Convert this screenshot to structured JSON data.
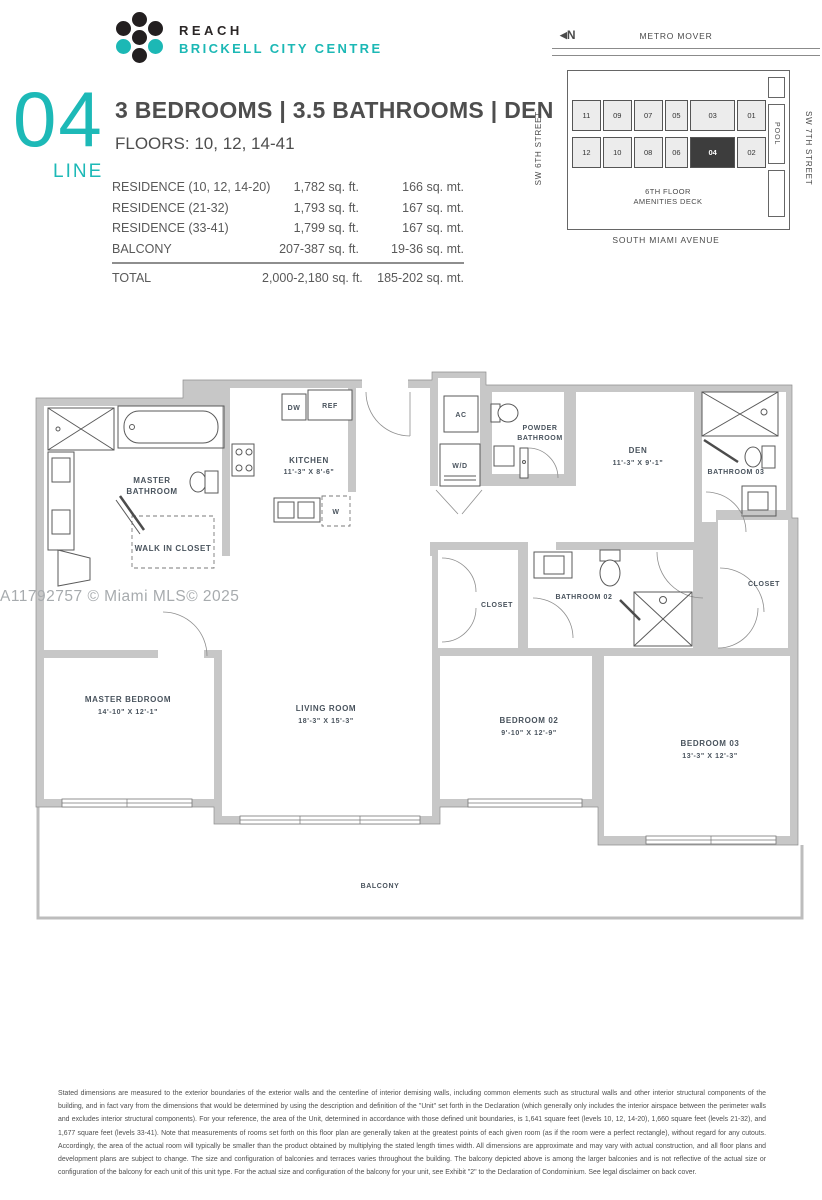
{
  "brand": {
    "line1": "REACH",
    "line2": "BRICKELL CITY CENTRE"
  },
  "unit": {
    "number": "04",
    "line_label": "LINE",
    "title": "3 BEDROOMS  |  3.5 BATHROOMS  |  DEN",
    "floors": "FLOORS: 10, 12, 14-41"
  },
  "area_table": {
    "rows": [
      {
        "label": "RESIDENCE (10, 12, 14-20)",
        "sqft": "1,782 sq. ft.",
        "sqmt": "166 sq. mt."
      },
      {
        "label": "RESIDENCE (21-32)",
        "sqft": "1,793 sq. ft.",
        "sqmt": "167 sq. mt."
      },
      {
        "label": "RESIDENCE (33-41)",
        "sqft": "1,799 sq. ft.",
        "sqmt": "167 sq. mt."
      },
      {
        "label": "BALCONY",
        "sqft": "207-387 sq. ft.",
        "sqmt": "19-36 sq. mt."
      }
    ],
    "total": {
      "label": "TOTAL",
      "sqft": "2,000-2,180 sq. ft.",
      "sqmt": "185-202 sq. mt."
    }
  },
  "key_plan": {
    "north": "N",
    "north_arrow": "◀",
    "metro_mover": "METRO MOVER",
    "street_left": "SW 6TH STREET",
    "street_right": "SW 7TH STREET",
    "avenue": "SOUTH MIAMI AVENUE",
    "pool": "POOL",
    "amenities_1": "6TH FLOOR",
    "amenities_2": "AMENITIES DECK",
    "top_row": [
      "11",
      "09",
      "07",
      "05",
      "03",
      "01"
    ],
    "bottom_row": [
      "12",
      "10",
      "08",
      "06",
      "04",
      "02"
    ],
    "highlighted_unit": "04"
  },
  "floor_plan": {
    "labels": {
      "master_bathroom_1": "MASTER",
      "master_bathroom_2": "BATHROOM",
      "walk_in_closet": "WALK IN CLOSET",
      "kitchen_1": "KITCHEN",
      "kitchen_2": "11'-3\" X 8'-6\"",
      "dw": "DW",
      "ref": "REF",
      "w": "W",
      "ac": "AC",
      "wd": "W/D",
      "powder_1": "POWDER",
      "powder_2": "BATHROOM",
      "den_1": "DEN",
      "den_2": "11'-3\" X 9'-1\"",
      "bathroom_03": "BATHROOM 03",
      "closet_right": "CLOSET",
      "closet_middle": "CLOSET",
      "bathroom_02": "BATHROOM 02",
      "master_bedroom_1": "MASTER BEDROOM",
      "master_bedroom_2": "14'-10\" X 12'-1\"",
      "living_room_1": "LIVING ROOM",
      "living_room_2": "18'-3\" X 15'-3\"",
      "bedroom_02_1": "BEDROOM 02",
      "bedroom_02_2": "9'-10\" X 12'-9\"",
      "bedroom_03_1": "BEDROOM 03",
      "bedroom_03_2": "13'-3\" X 12'-3\"",
      "balcony": "BALCONY"
    }
  },
  "watermark": "A11792757 © Miami MLS© 2025",
  "disclaimer": "Stated dimensions are measured to the exterior boundaries of the exterior walls and the centerline of interior demising walls, including common elements such as structural walls and other interior structural components of the building, and in fact vary from the dimensions that would be determined by using the description and definition of the \"Unit\" set forth in the Declaration (which generally only includes the interior airspace between the perimeter walls and excludes interior structural components). For your reference, the area of the Unit, determined in accordance with those defined unit boundaries, is 1,641 square feet (levels 10, 12, 14-20), 1,660 square feet (levels 21-32), and 1,677 square feet (levels 33-41). Note that measurements of rooms set forth on this floor plan are generally taken at the greatest points of each given room (as if the room were a perfect rectangle), without regard for any cutouts. Accordingly, the area of the actual room will typically be smaller than the product obtained by multiplying the stated length times width. All dimensions are approximate and may vary with actual construction, and all floor plans and development plans are subject to change. The size and configuration of balconies and terraces varies throughout the building. The balcony depicted above is among the larger balconies and is not reflective of the actual size or configuration of the balcony for each unit of this unit type. For the actual size and configuration of the balcony for your unit, see Exhibit \"2\" to the Declaration of Condominium. See legal disclaimer on back cover.",
  "colors": {
    "teal": "#1cb8b5",
    "heading_gray": "#4e4e4e",
    "table_gray": "#595959",
    "wall_gray": "#c7c7c7",
    "plan_label": "#49535d",
    "keyplan_highlight": "#3d3d3d",
    "watermark_gray": "#a7abae"
  }
}
